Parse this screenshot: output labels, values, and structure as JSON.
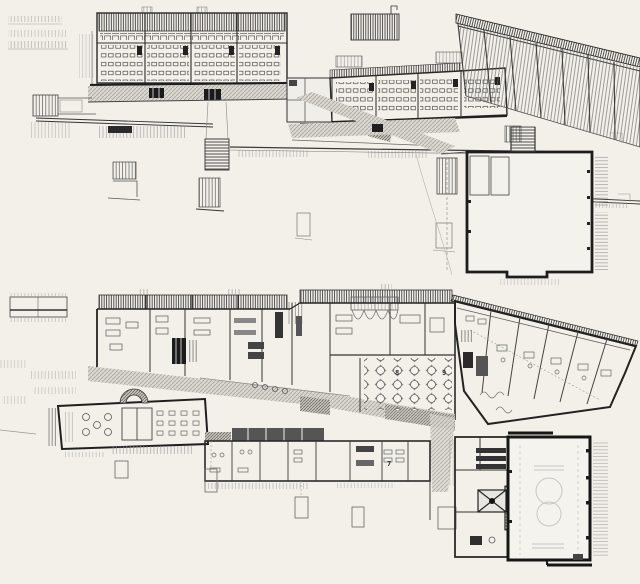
{
  "drawing": {
    "kind": "scanned architectural floor plans, two levels",
    "labels": {
      "room7": "7",
      "room8": "8",
      "room9": "9"
    },
    "colors": {
      "paper": "#f2f0e9",
      "ink_heavy": "#1d1d1d",
      "ink_mid": "#474747",
      "ink_light": "#8a8a8a",
      "ink_faint": "#c2c2c2",
      "corridor_tint": "#dad7d0",
      "corridor_dark": "#c7c4bd"
    }
  }
}
